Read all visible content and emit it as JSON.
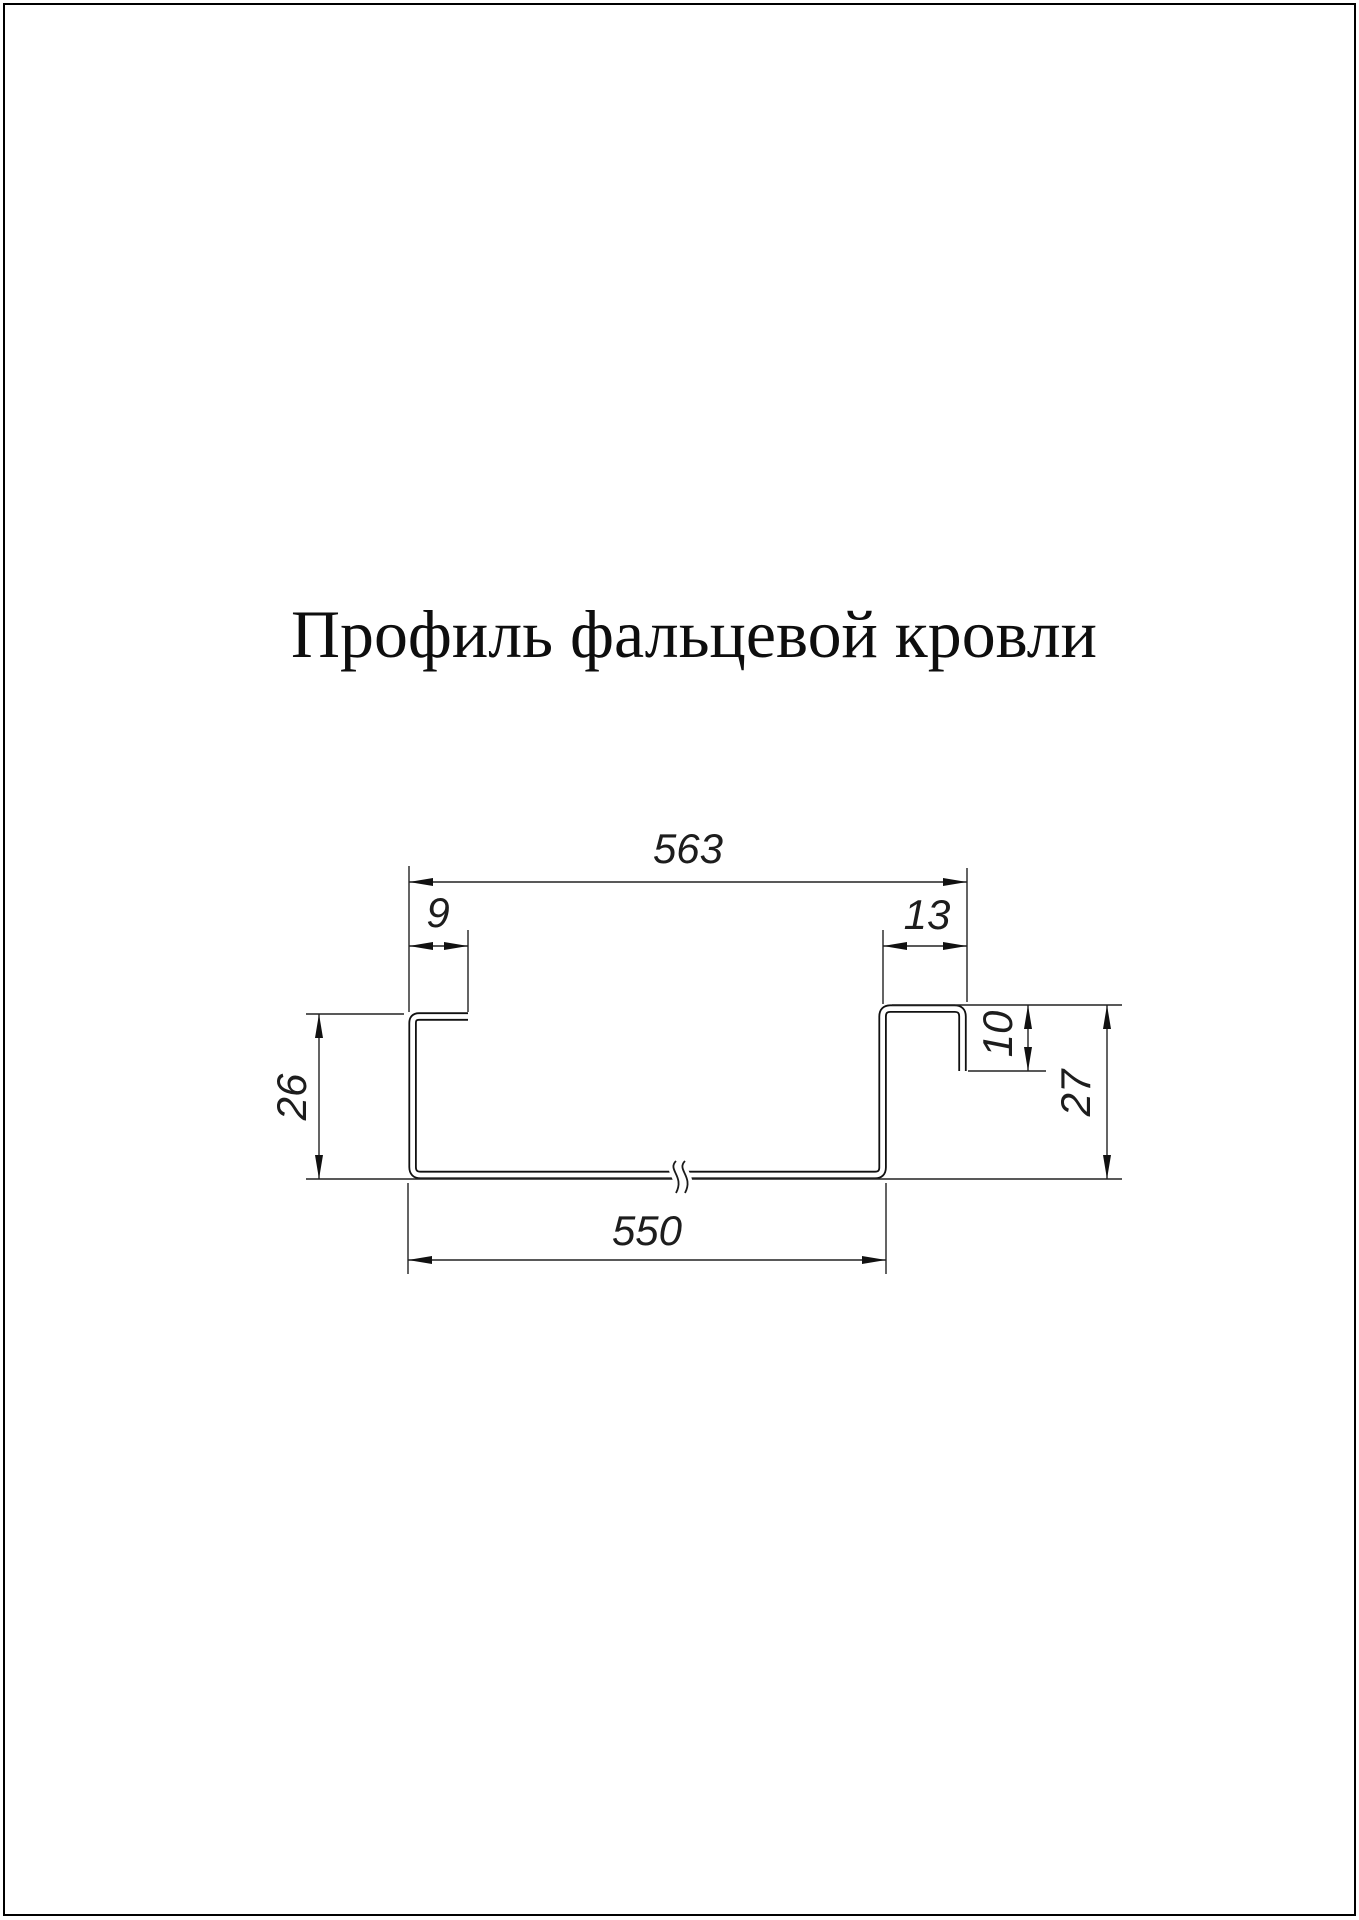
{
  "page": {
    "title": "Профиль фальцевой кровли",
    "background_color": "#ffffff",
    "line_color": "#1d1d1d",
    "border_color": "#000000"
  },
  "drawing": {
    "name": "standing-seam-roof-profile-cross-section",
    "dimensions": {
      "overall_top_width": "563",
      "left_lip_width": "9",
      "right_seam_width": "13",
      "left_height": "26",
      "right_step_height": "10",
      "right_height": "27",
      "bottom_width": "550"
    }
  }
}
